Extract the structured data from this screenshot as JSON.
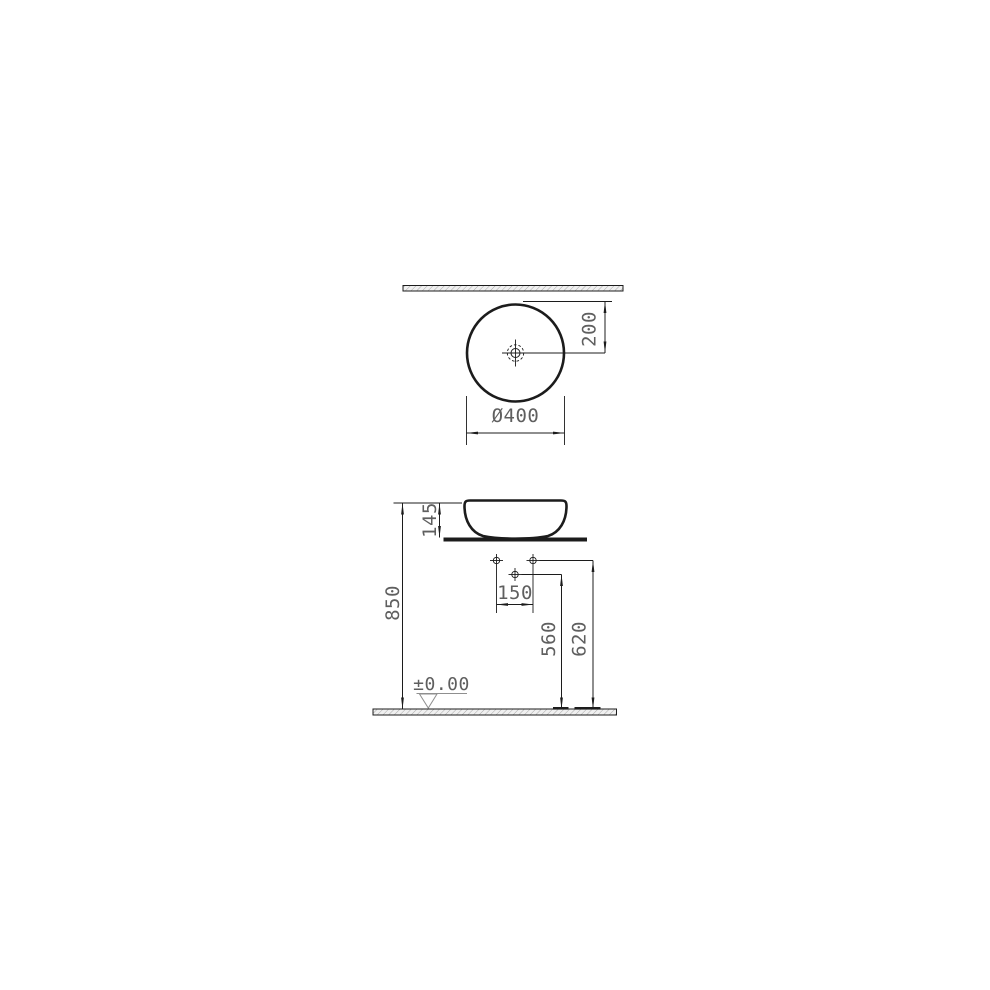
{
  "drawing": {
    "type": "technical-dimension-drawing",
    "subject": "round-countertop-washbasin",
    "colors": {
      "line": "#1c1c1c",
      "dim_text": "#5f5f5f",
      "datum_symbol": "#8f8f8f",
      "hatch_fill": "#f0f0f0",
      "hatch_stroke": "#a8a8a8",
      "background": "#ffffff"
    },
    "top_view": {
      "labels": {
        "diameter": "Ø400",
        "center_to_back": "200"
      }
    },
    "side_view": {
      "labels": {
        "basin_height": "145",
        "rim_height_from_floor": "850",
        "hole_spacing": "150",
        "mid_hole_height": "560",
        "top_hole_height": "620",
        "floor_datum": "±0.00"
      }
    }
  }
}
